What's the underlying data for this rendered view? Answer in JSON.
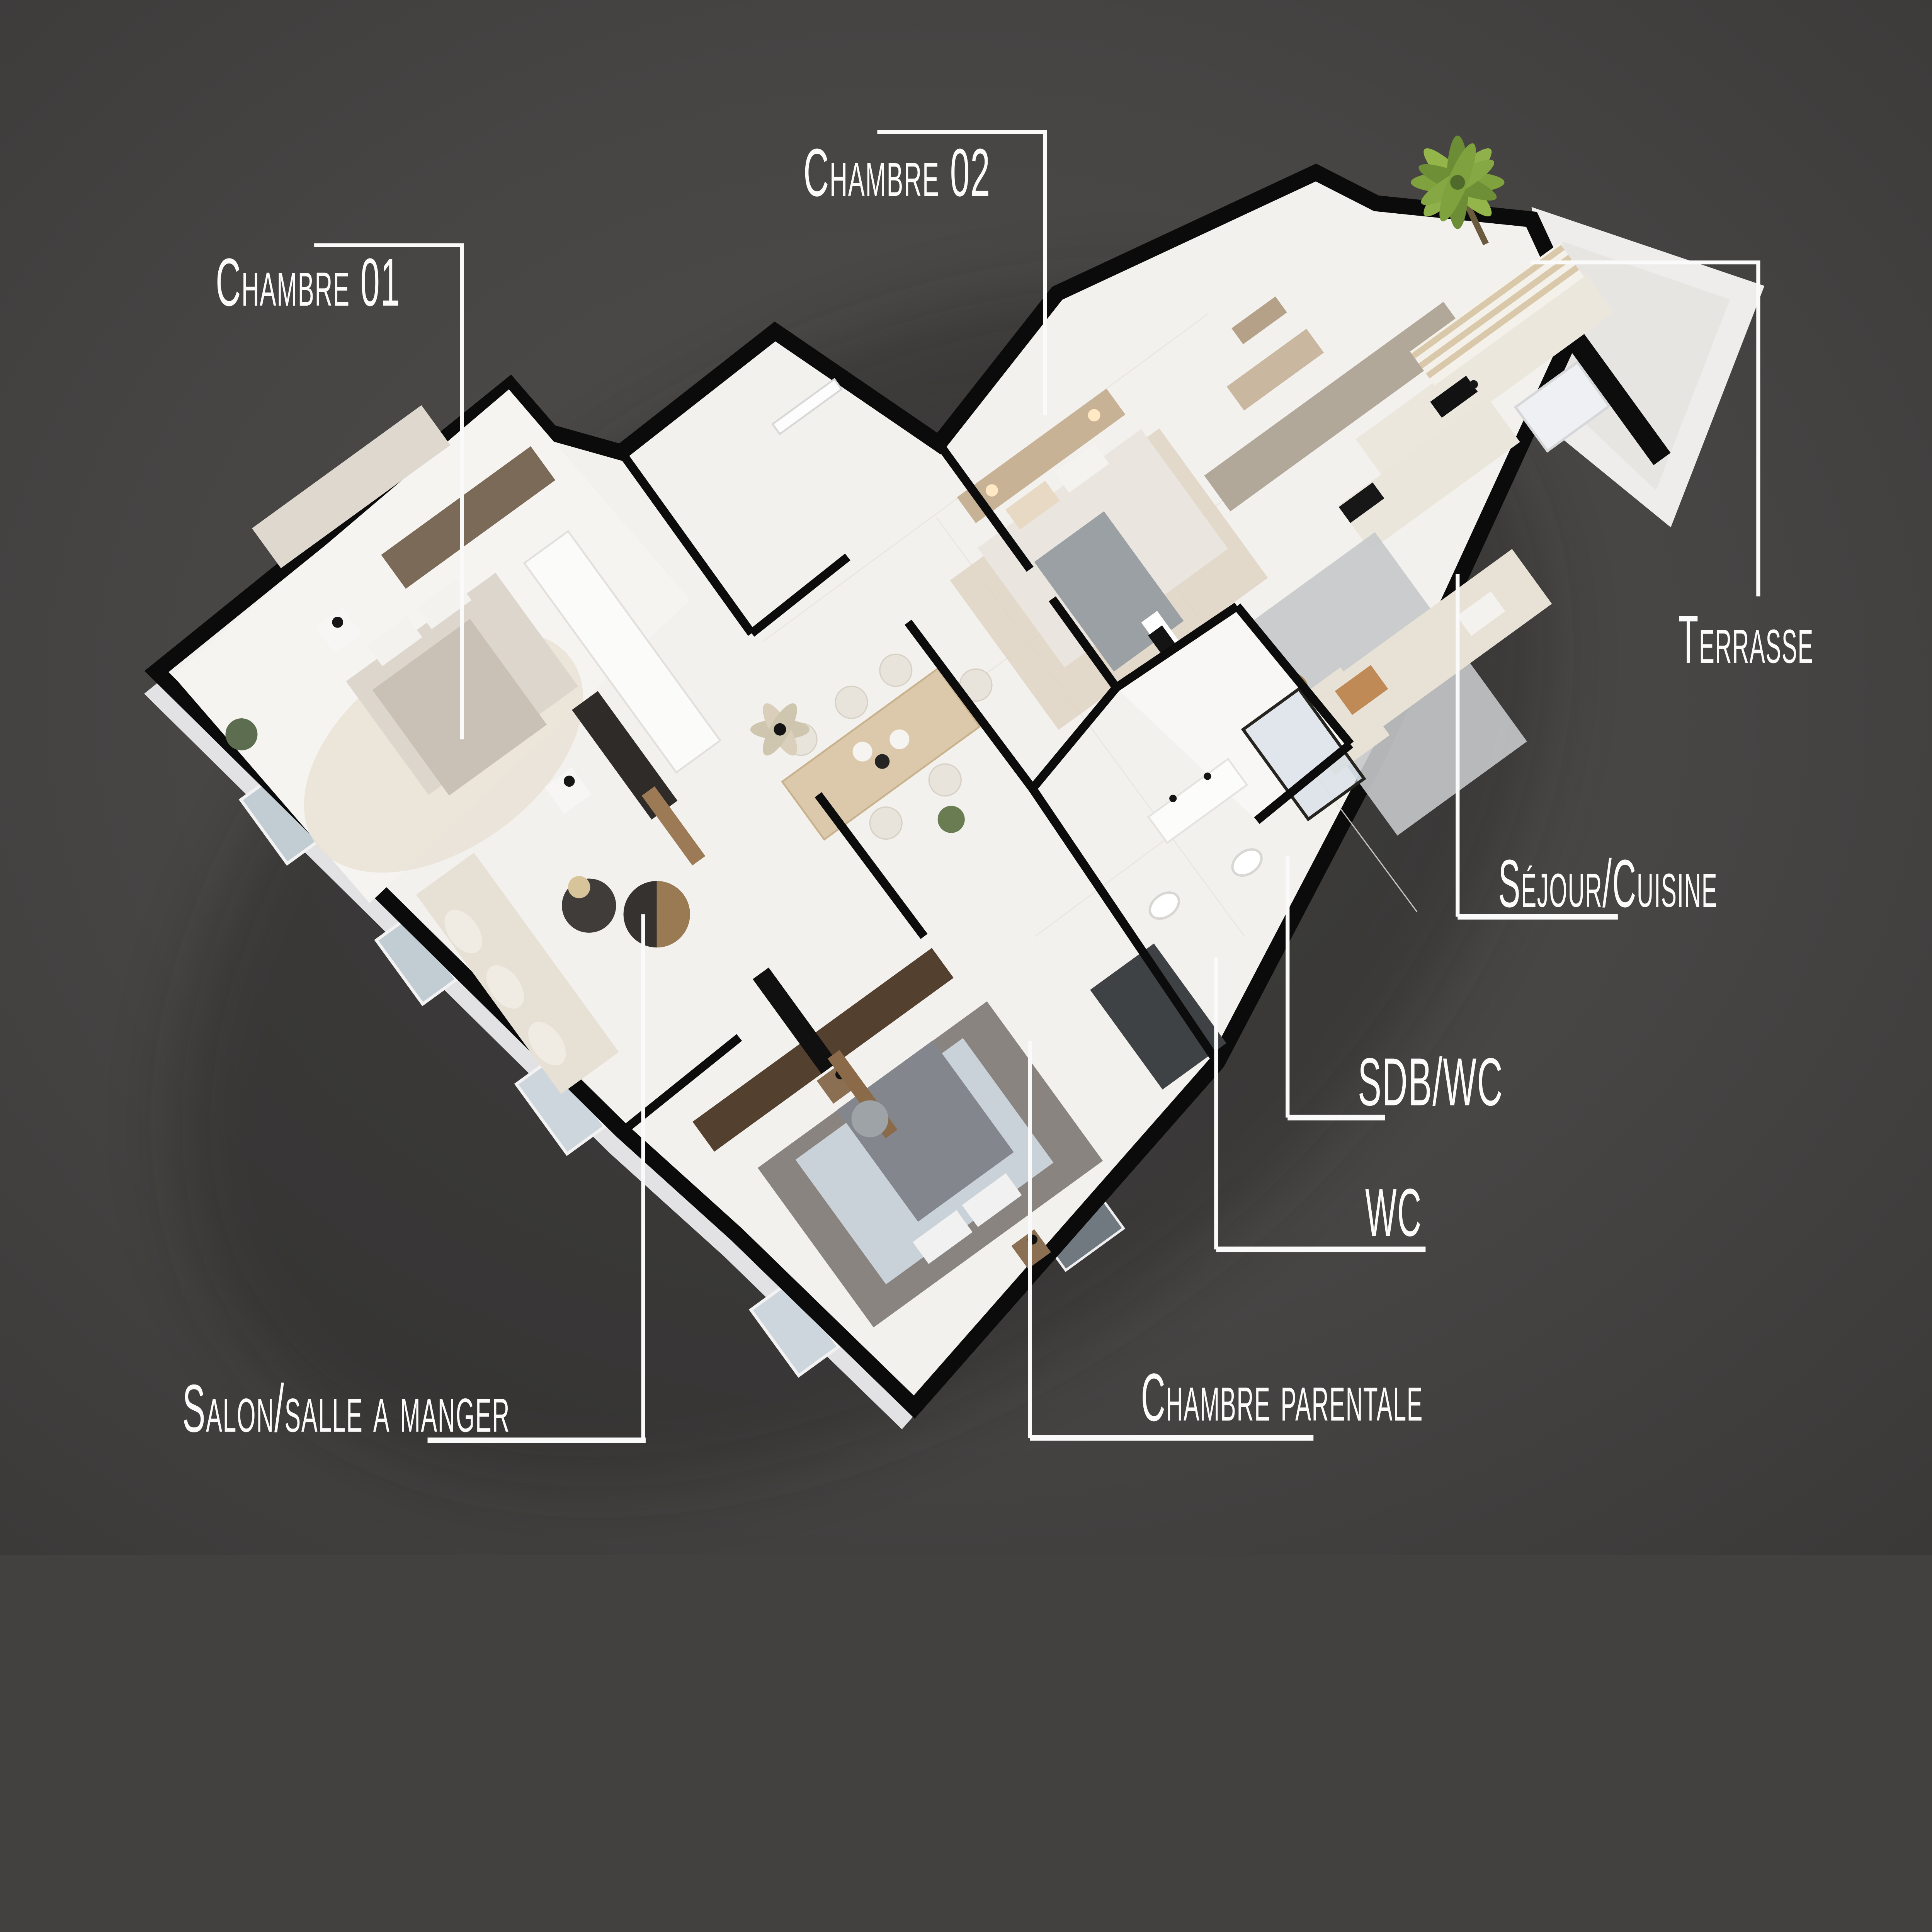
{
  "scene": {
    "type": "isometric-floorplan-render",
    "background_color": "#454342",
    "label_color": "#fbfbfb",
    "wall_cut_color": "#0c0c0c",
    "floor_color": "#f3f1ed",
    "facade_color": "#e4e4e6"
  },
  "rooms": [
    {
      "id": "chambre-01",
      "label": "Chambre 01"
    },
    {
      "id": "chambre-02",
      "label": "Chambre 02"
    },
    {
      "id": "terrasse",
      "label": "Terrasse"
    },
    {
      "id": "sejour-cuisine",
      "label": "Séjour/Cuisine"
    },
    {
      "id": "sdb-wc",
      "label": "SDB/WC"
    },
    {
      "id": "wc",
      "label": "WC"
    },
    {
      "id": "salon-salle-a-manger",
      "label": "Salon/salle a manger"
    },
    {
      "id": "chambre-parentale",
      "label": "Chambre parentale"
    }
  ],
  "palette": {
    "wood_dark": "#5a4536",
    "wood_light": "#c7b296",
    "greige_cabinet": "#b2a89a",
    "cream_sofa": "#e6e0d5",
    "gray_bedding": "#83868c",
    "terrace_floor": "#e7e5e2",
    "palm_green": "#7fa13e",
    "shower_glass": "#d3dde6"
  }
}
